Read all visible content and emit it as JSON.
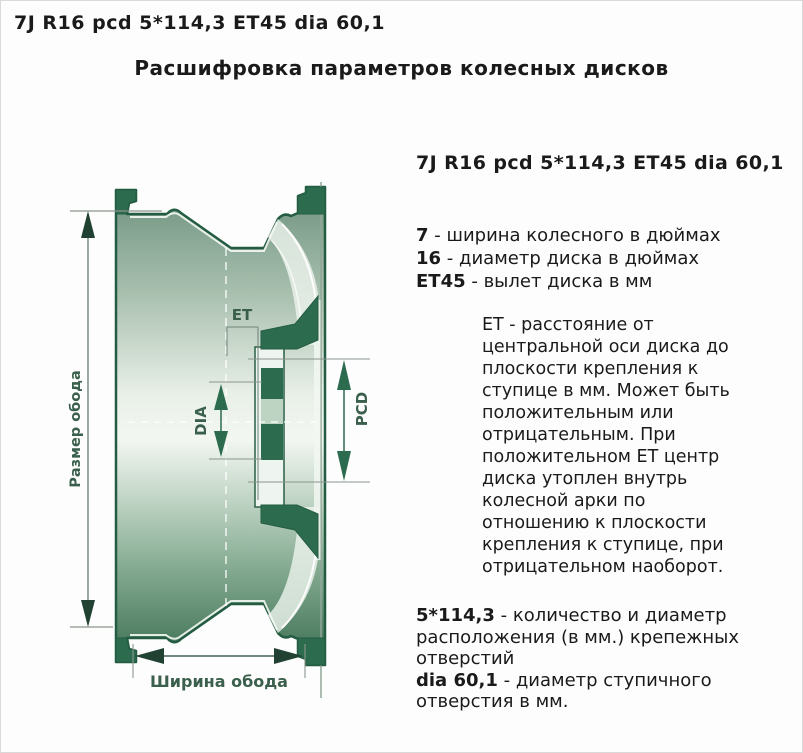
{
  "page": {
    "top_title": "7J R16 pcd 5*114,3 ET45 dia 60,1",
    "heading": "Расшифровка параметров колесных дисков"
  },
  "diagram": {
    "labels": {
      "rim_size": "Размер обода",
      "et": "ET",
      "dia": "DIA",
      "pcd": "PCD",
      "rim_width": "Ширина обода"
    },
    "colors": {
      "outline_green": "#235c42",
      "dark_green": "#2d6b4e",
      "label_green": "#3a5f4c",
      "fill_light": "#eef4ee"
    }
  },
  "info": {
    "header": "7J R16 pcd 5*114,3 ET45 dia 60,1",
    "items": [
      {
        "term": "7",
        "desc": "- ширина колесного в дюймах"
      },
      {
        "term": "16",
        "desc": "- диаметр диска в дюймах"
      },
      {
        "term": "ET45",
        "desc": "- вылет диска в мм"
      }
    ],
    "et_note": "ET - расстояние от центральной оси диска до плоскости крепления к ступице в мм. Может быть положительным или отрицательным. При положительном ET центр диска утоплен внутрь колесной арки по отношению к плоскости крепления к ступице, при отрицательном наоборот.",
    "bottom": [
      {
        "term": "5*114,3",
        "desc": "- количество и диаметр расположения (в мм.) крепежных отверстий"
      },
      {
        "term": "dia 60,1",
        "desc": "- диаметр ступичного отверстия в мм."
      }
    ]
  }
}
